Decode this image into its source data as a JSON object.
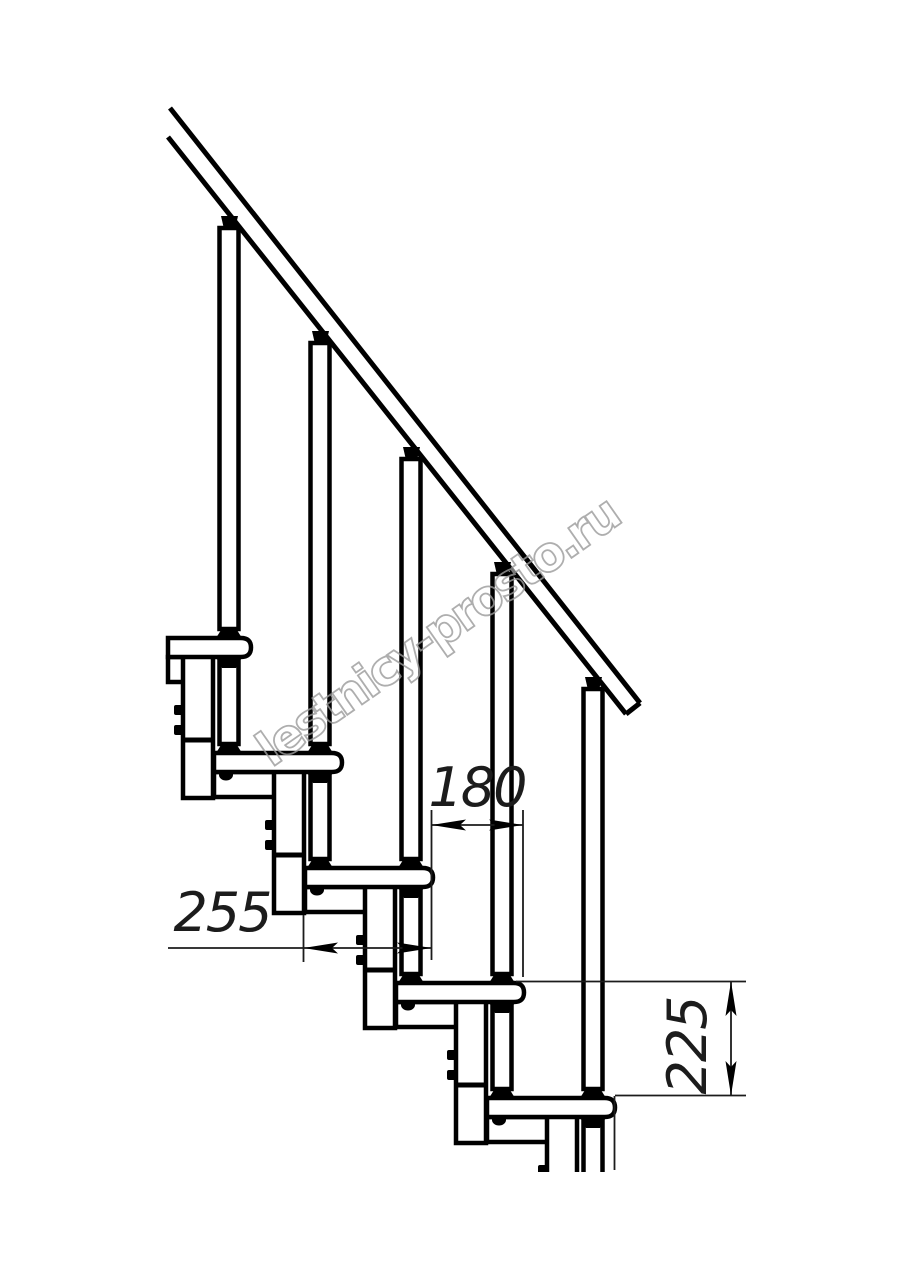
{
  "drawing": {
    "watermark": "lestnicy-prosto.ru",
    "dimensions": {
      "tread_depth_label": "255",
      "step_run_label": "180",
      "step_rise_label": "225"
    },
    "colors": {
      "background": "#ffffff",
      "line": "#000000",
      "dimension_line": "#1c1c1c",
      "watermark": "#9a9a9a"
    }
  }
}
